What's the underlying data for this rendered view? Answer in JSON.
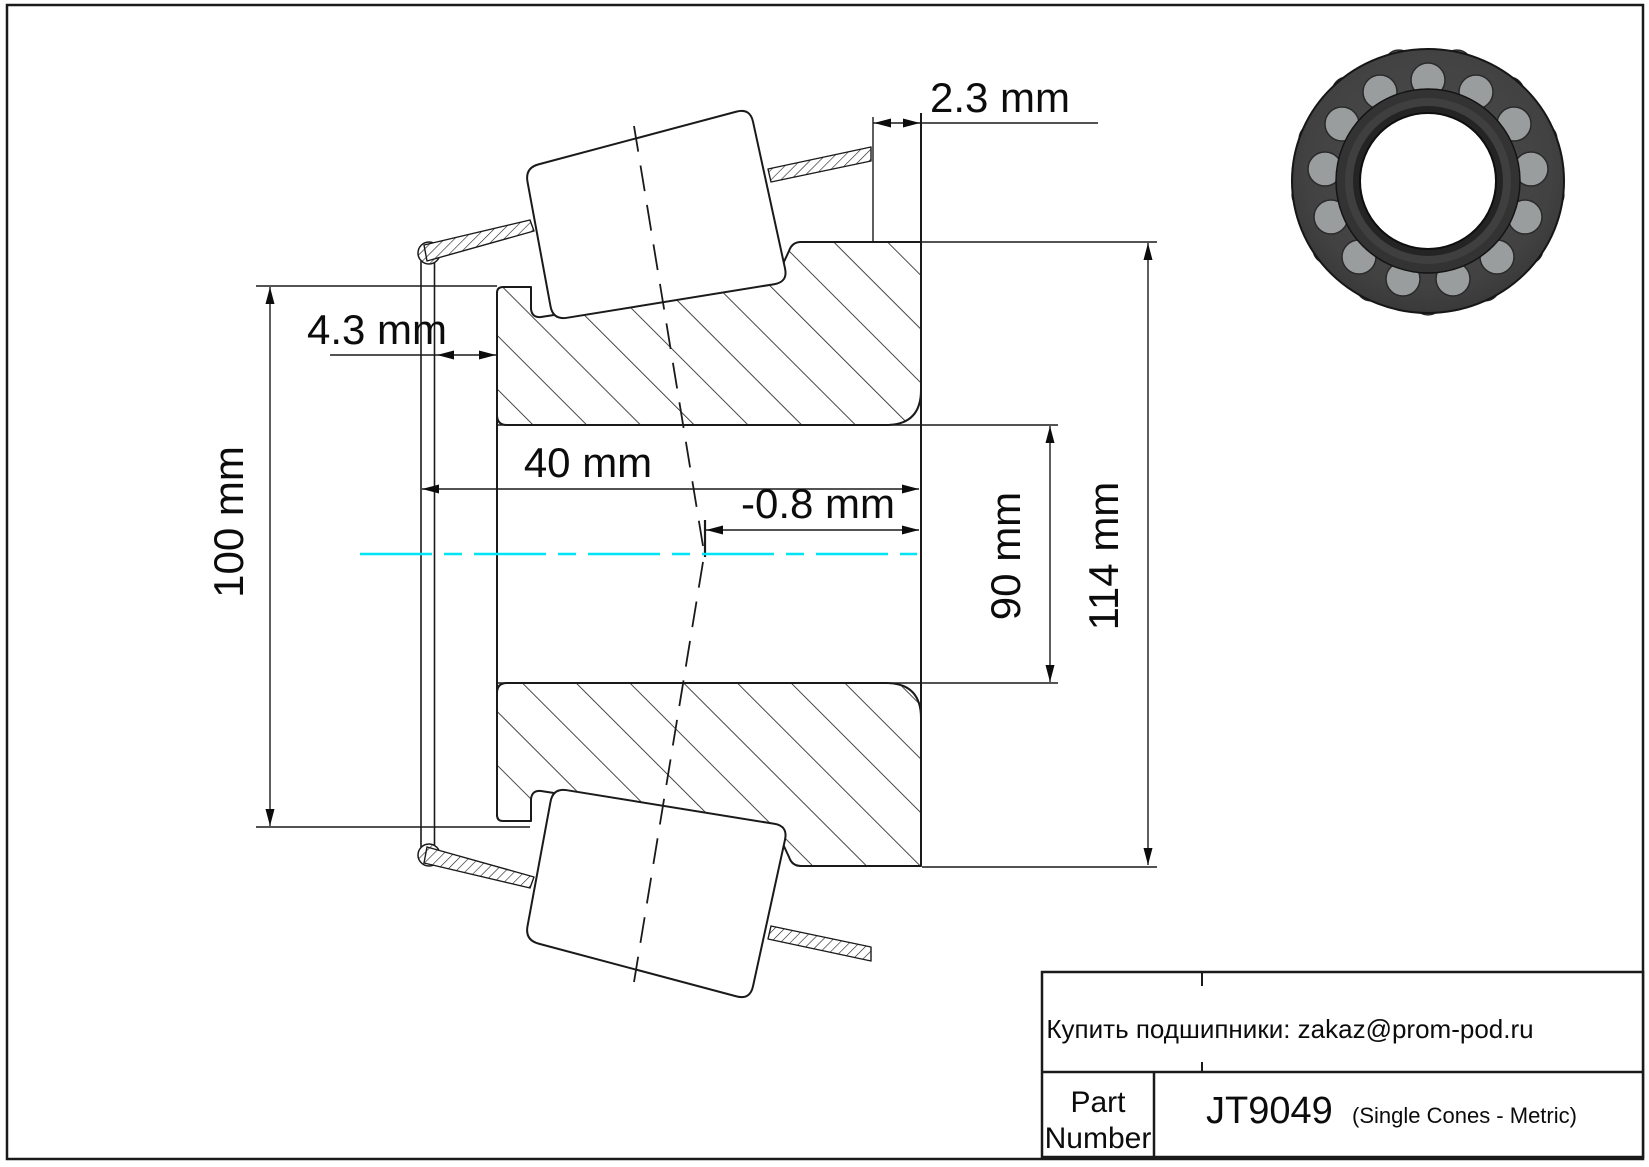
{
  "page": {
    "background": "#ffffff",
    "border_color": "#1a1a1a"
  },
  "drawing": {
    "type": "tapered-roller-bearing-single-cone-cross-section",
    "centerline_color": "#00e4f5",
    "dimensions": {
      "back_protrusion": "2.3 mm",
      "front_gap": "4.3 mm",
      "cone_width": "40 mm",
      "effective_center": "-0.8 mm",
      "flange_od": "100 mm",
      "bore": "90 mm",
      "outer_rib_od": "114 mm"
    }
  },
  "title_block": {
    "contact": "Купить подшипники: zakaz@prom-pod.ru",
    "part_label_1": "Part",
    "part_label_2": "Number",
    "part_number": "JT9049",
    "series": "(Single Cones - Metric)"
  }
}
